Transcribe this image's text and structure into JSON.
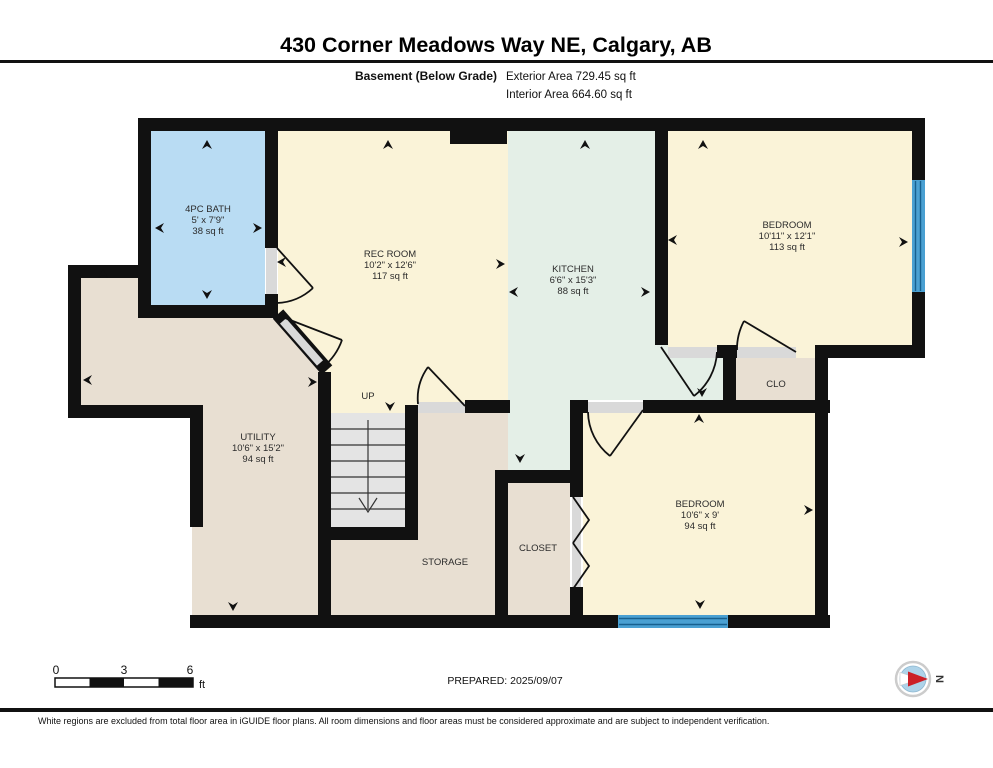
{
  "header": {
    "title": "430 Corner Meadows Way NE, Calgary, AB",
    "floor_label": "Basement (Below Grade)",
    "exterior_area": "Exterior Area 729.45 sq ft",
    "interior_area": "Interior Area 664.60 sq ft"
  },
  "rooms": {
    "bath": {
      "name": "4PC BATH",
      "dims": "5' x 7'9\"",
      "area": "38 sq ft"
    },
    "rec": {
      "name": "REC ROOM",
      "dims": "10'2\" x 12'6\"",
      "area": "117 sq ft"
    },
    "kitchen": {
      "name": "KITCHEN",
      "dims": "6'6\" x 15'3\"",
      "area": "88 sq ft"
    },
    "bedroom1": {
      "name": "BEDROOM",
      "dims": "10'11\" x 12'1\"",
      "area": "113 sq ft"
    },
    "clo": {
      "name": "CLO"
    },
    "utility": {
      "name": "UTILITY",
      "dims": "10'6\" x 15'2\"",
      "area": "94 sq ft"
    },
    "storage": {
      "name": "STORAGE"
    },
    "closet": {
      "name": "CLOSET"
    },
    "bedroom2": {
      "name": "BEDROOM",
      "dims": "10'6\" x 9'",
      "area": "94 sq ft"
    },
    "stairs": {
      "label": "UP"
    }
  },
  "scale_bar": {
    "labels": [
      "0",
      "3",
      "6"
    ],
    "unit": "ft"
  },
  "footer": {
    "prepared": "PREPARED: 2025/09/07",
    "disclaimer": "White regions are excluded from total floor area in iGUIDE floor plans. All room dimensions and floor areas must be considered approximate and are subject to independent verification."
  },
  "compass": {
    "label": "N"
  },
  "colors": {
    "room_cream": "#faf3d8",
    "room_mint": "#e4efe7",
    "room_tan": "#e8dfd2",
    "room_blue": "#b9dcf3",
    "stairs_gray": "#e4e4e4",
    "wall_black": "#111111",
    "window_blue": "#4aa0d2"
  }
}
